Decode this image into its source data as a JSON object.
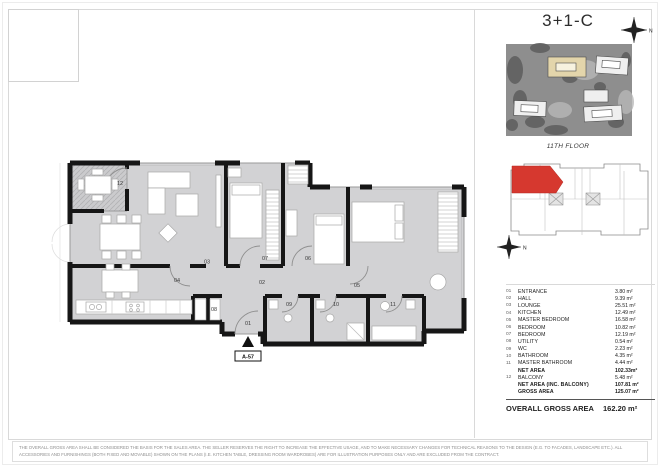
{
  "page": {
    "unit_title": "3+1-C",
    "floor_caption": "11TH FLOOR",
    "north_label": "N",
    "entrance_marker": "A-57",
    "disclaimer": "THE OVERALL GROSS AREA SHALL BE CONSIDERED THE BASIS FOR THE SALES AREA. THE SELLER RESERVES THE RIGHT TO INCREASE THE EFFECTIVE USAGE, AND TO MAKE NECESSARY CHANGES FOR TECHNICAL REASONS TO THE DESIGN (E.G. TO FACADES, LANDSCAPE ETC.). ALL ACCESSORIES AND FURNISHINGS (BOTH FIXED AND MOVABLE) SHOWN ON THE PLANS (I.E. KITCHEN TABLE, DRESSING ROOM WARDROBES) ARE FOR ILLUSTRATION PURPOSES ONLY AND ARE EXCLUDED FROM THE CONTRACT."
  },
  "plan": {
    "labels": {
      "r01": "01",
      "r02": "02",
      "r03": "03",
      "r04": "04",
      "r05": "05",
      "r06": "06",
      "r07": "07",
      "r08": "08",
      "r09": "09",
      "r10": "10",
      "r11": "11",
      "r12": "12"
    }
  },
  "legend": {
    "rows": [
      {
        "num": "01",
        "label": "ENTRANCE",
        "value": "3.80 m²",
        "bold": false
      },
      {
        "num": "02",
        "label": "HALL",
        "value": "9.39 m²",
        "bold": false
      },
      {
        "num": "03",
        "label": "LOUNGE",
        "value": "25.51 m²",
        "bold": false
      },
      {
        "num": "04",
        "label": "KITCHEN",
        "value": "12.49 m²",
        "bold": false
      },
      {
        "num": "05",
        "label": "MASTER BEDROOM",
        "value": "16.58 m²",
        "bold": false
      },
      {
        "num": "06",
        "label": "BEDROOM",
        "value": "10.82 m²",
        "bold": false
      },
      {
        "num": "07",
        "label": "BEDROOM",
        "value": "12.19 m²",
        "bold": false
      },
      {
        "num": "08",
        "label": "UTILITY",
        "value": "0.54 m²",
        "bold": false
      },
      {
        "num": "09",
        "label": "WC",
        "value": "2.23 m²",
        "bold": false
      },
      {
        "num": "10",
        "label": "BATHROOM",
        "value": "4.35 m²",
        "bold": false
      },
      {
        "num": "11",
        "label": "MASTER BATHROOM",
        "value": "4.44 m²",
        "bold": false
      },
      {
        "num": "",
        "label": "NET AREA",
        "value": "102.33m²",
        "bold": true
      },
      {
        "num": "12",
        "label": "BALCONY",
        "value": "5.48 m²",
        "bold": false
      },
      {
        "num": "",
        "label": "NET AREA (INC. BALCONY)",
        "value": "107.81 m²",
        "bold": true
      },
      {
        "num": "",
        "label": "GROSS AREA",
        "value": "125.07 m²",
        "bold": true
      }
    ],
    "total": {
      "label": "OVERALL GROSS AREA",
      "value": "162.20 m²"
    }
  },
  "colors": {
    "unit_red": "#d6382f",
    "wall": "#161616",
    "floor_gray": "#d2d2d4",
    "site_highlight": "#e3d5ab"
  }
}
